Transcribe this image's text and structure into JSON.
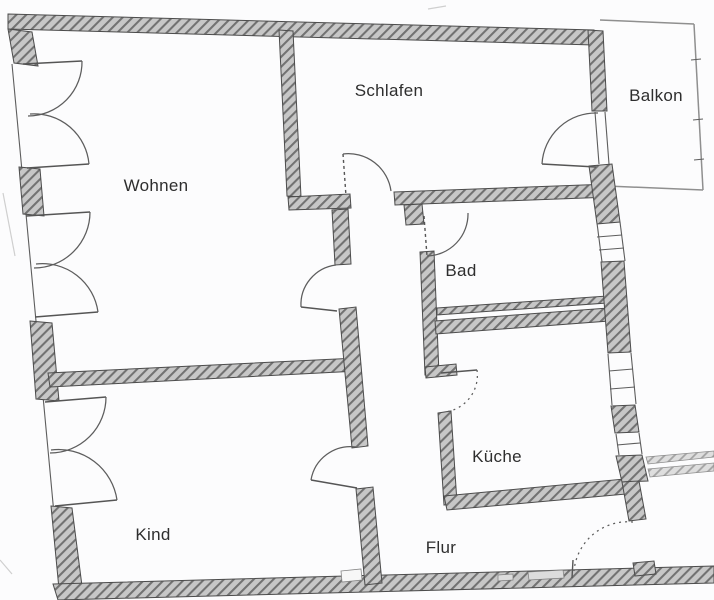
{
  "title": "Apartment floor plan (Grundriss)",
  "labels": {
    "wohnen": "Wohnen",
    "schlafen": "Schlafen",
    "balkon": "Balkon",
    "bad": "Bad",
    "kueche": "Küche",
    "kind": "Kind",
    "flur": "Flur"
  },
  "colors": {
    "background": "#fcfcfd",
    "wall_fill": "#c7c7c7",
    "wall_hatch": "#727272",
    "wall_outline": "#4c4c4c",
    "line": "#5d5d5d",
    "label_text": "#2e2e2e"
  }
}
